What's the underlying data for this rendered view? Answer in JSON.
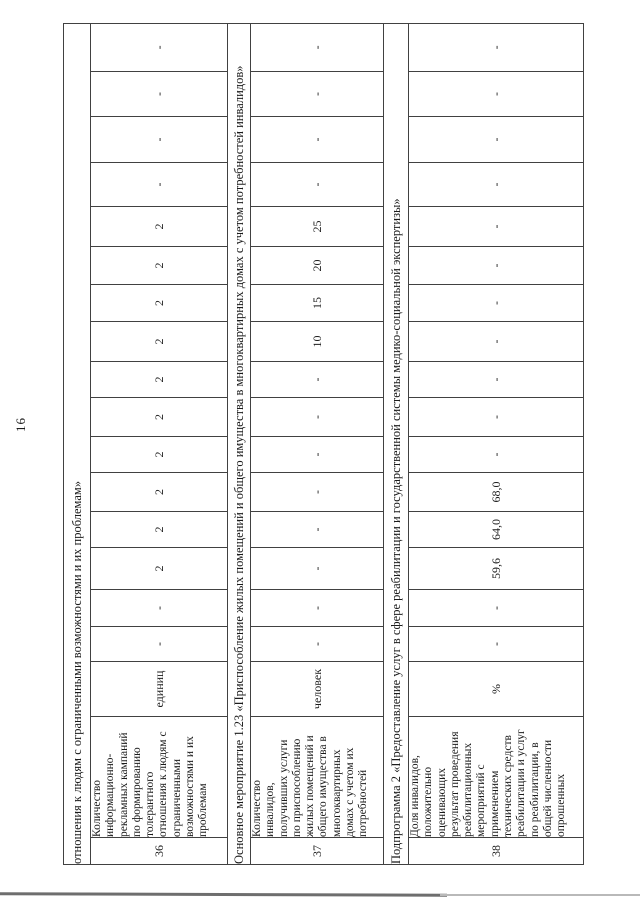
{
  "page": {
    "number": "16"
  },
  "colors": {
    "paper": "#ffffff",
    "table_border": "#414141",
    "text": "#1b1b1b",
    "scan_edge": "#6e6e6e"
  },
  "table": {
    "value_column_count": 16,
    "rows": [
      {
        "type": "continuation",
        "text": "отношения к людям с ограниченными возможностями и их проблемам»"
      },
      {
        "type": "indicator",
        "num": "36",
        "name_lines": [
          "Количество",
          "информационно-",
          "рекламных кампаний",
          "по формированию",
          "толерантного",
          "отношения к людям с",
          "ограниченными",
          "возможностями и их",
          "проблемам"
        ],
        "unit": "единиц",
        "values": [
          "-",
          "-",
          "2",
          "2",
          "2",
          "2",
          "2",
          "2",
          "2",
          "2",
          "2",
          "2",
          "-",
          "-",
          "-",
          "-"
        ]
      },
      {
        "type": "section",
        "text": "Основное мероприятие 1.23 «Приспособление жилых помещений и общего имущества в многоквартирных домах с учетом потребностей инвалидов»"
      },
      {
        "type": "indicator",
        "num": "37",
        "name_lines": [
          "Количество",
          "инвалидов,",
          "получивших услуги",
          "по приспособлению",
          "жилых помещений и",
          "общего имущества в",
          "многоквартирных",
          "домах с учетом их",
          "потребностей"
        ],
        "unit": "человек",
        "values": [
          "-",
          "-",
          "-",
          "-",
          "-",
          "-",
          "-",
          "-",
          "10",
          "15",
          "20",
          "25",
          "-",
          "-",
          "-",
          "-"
        ]
      },
      {
        "type": "section",
        "text": "Подпрограмма 2 «Предоставление услуг в сфере реабилитации и государственной системы медико-социальной экспертизы»"
      },
      {
        "type": "indicator",
        "num": "38",
        "name_lines": [
          "Доля инвалидов,",
          "положительно",
          "оценивающих",
          "результат проведения",
          "реабилитационных",
          "мероприятий с",
          "применением",
          "технических средств",
          "реабилитации и услуг",
          "по реабилитации, в",
          "общей численности",
          "опрошенных"
        ],
        "unit": "%",
        "values": [
          "-",
          "-",
          "59,6",
          "64,0",
          "68,0",
          "-",
          "-",
          "-",
          "-",
          "-",
          "-",
          "-",
          "-",
          "-",
          "-",
          "-"
        ]
      }
    ]
  }
}
